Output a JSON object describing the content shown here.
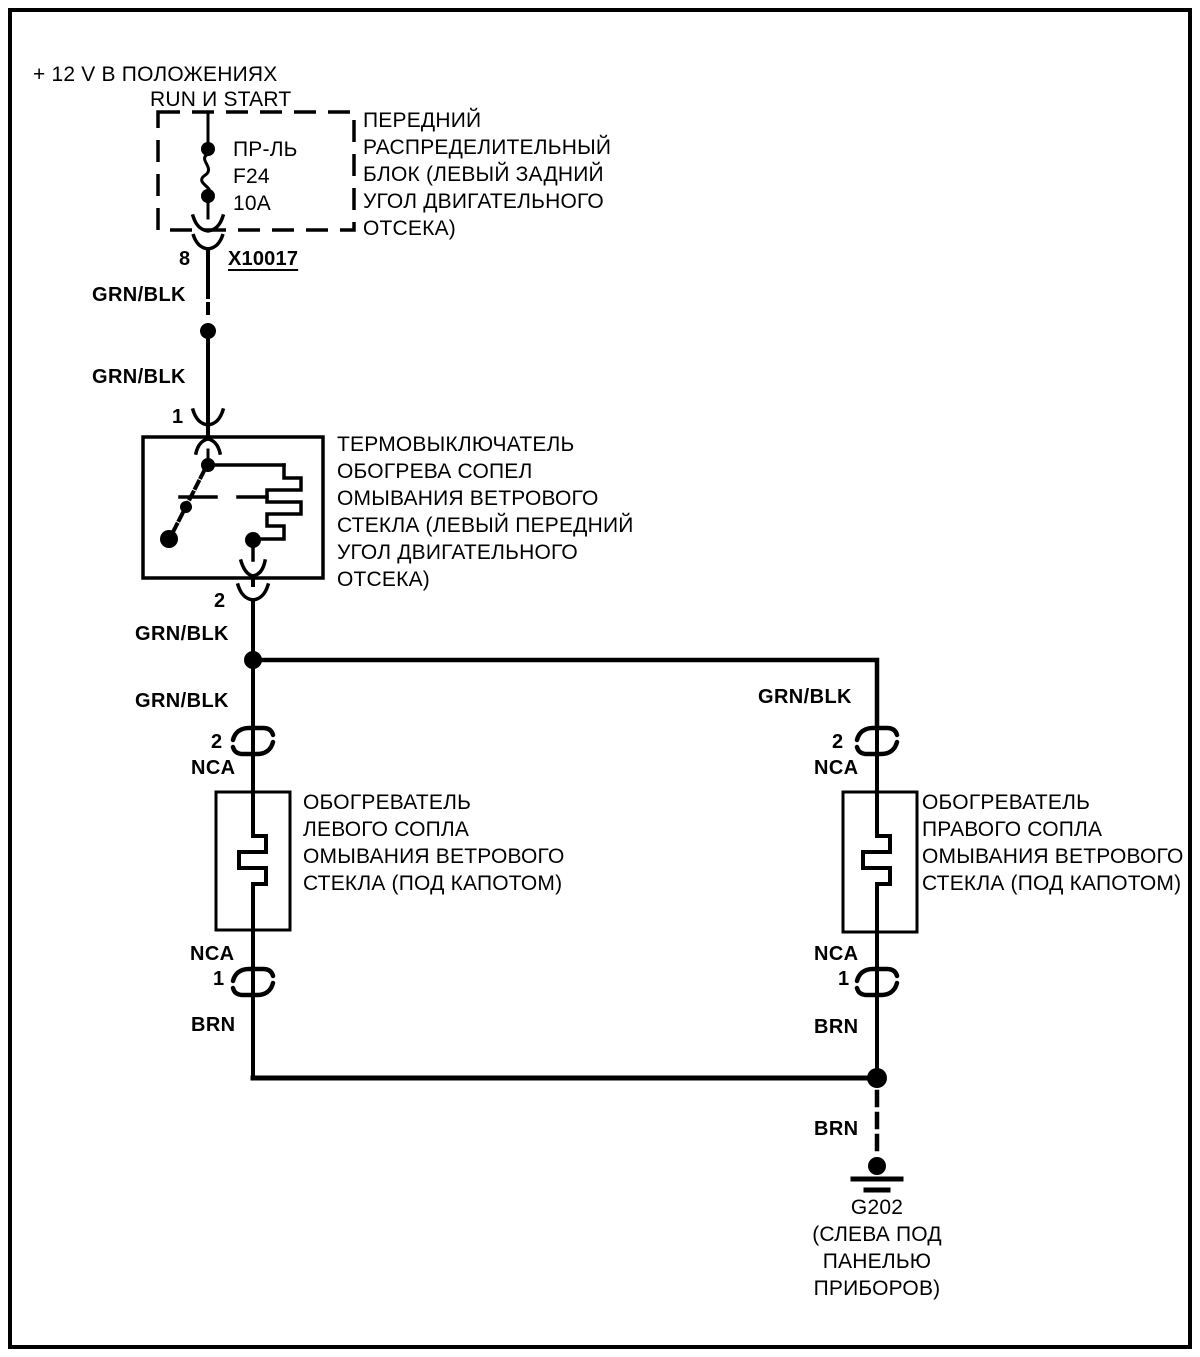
{
  "power": {
    "line1": "+ 12 V В ПОЛОЖЕНИЯХ",
    "line2": "RUN И START"
  },
  "fuse_box": {
    "fuse_name": "ПР-ЛЬ",
    "fuse_id": "F24",
    "fuse_rating": "10A",
    "label_lines": [
      "ПЕРЕДНИЙ",
      "РАСПРЕДЕЛИТЕЛЬНЫЙ",
      "БЛОК (ЛЕВЫЙ ЗАДНИЙ",
      "УГОЛ ДВИГАТЕЛЬНОГО",
      "ОТСЕКА)"
    ]
  },
  "connector": {
    "pin": "8",
    "id": "X10017"
  },
  "wire_colors": {
    "grn_blk": "GRN/BLK",
    "nca": "NCA",
    "brn": "BRN"
  },
  "thermal_switch": {
    "pin_in": "1",
    "pin_out": "2",
    "label_lines": [
      "ТЕРМОВЫКЛЮЧАТЕЛЬ",
      "ОБОГРЕВА СОПЕЛ",
      "ОМЫВАНИЯ ВЕТРОВОГО",
      "СТЕКЛА (ЛЕВЫЙ ПЕРЕДНИЙ",
      "УГОЛ ДВИГАТЕЛЬНОГО",
      "ОТСЕКА)"
    ]
  },
  "left_heater": {
    "pin_in": "2",
    "pin_out": "1",
    "label_lines": [
      "ОБОГРЕВАТЕЛЬ",
      "ЛЕВОГО СОПЛА",
      "ОМЫВАНИЯ ВЕТРОВОГО",
      "СТЕКЛА (ПОД КАПОТОМ)"
    ]
  },
  "right_heater": {
    "pin_in": "2",
    "pin_out": "1",
    "label_lines": [
      "ОБОГРЕВАТЕЛЬ",
      "ПРАВОГО СОПЛА",
      "ОМЫВАНИЯ ВЕТРОВОГО",
      "СТЕКЛА (ПОД КАПОТОМ)"
    ]
  },
  "ground": {
    "id": "G202",
    "location_lines": [
      "(СЛЕВА ПОД",
      "ПАНЕЛЬЮ",
      "ПРИБОРОВ)"
    ]
  },
  "colors": {
    "ink": "#000000",
    "paper": "#ffffff"
  }
}
